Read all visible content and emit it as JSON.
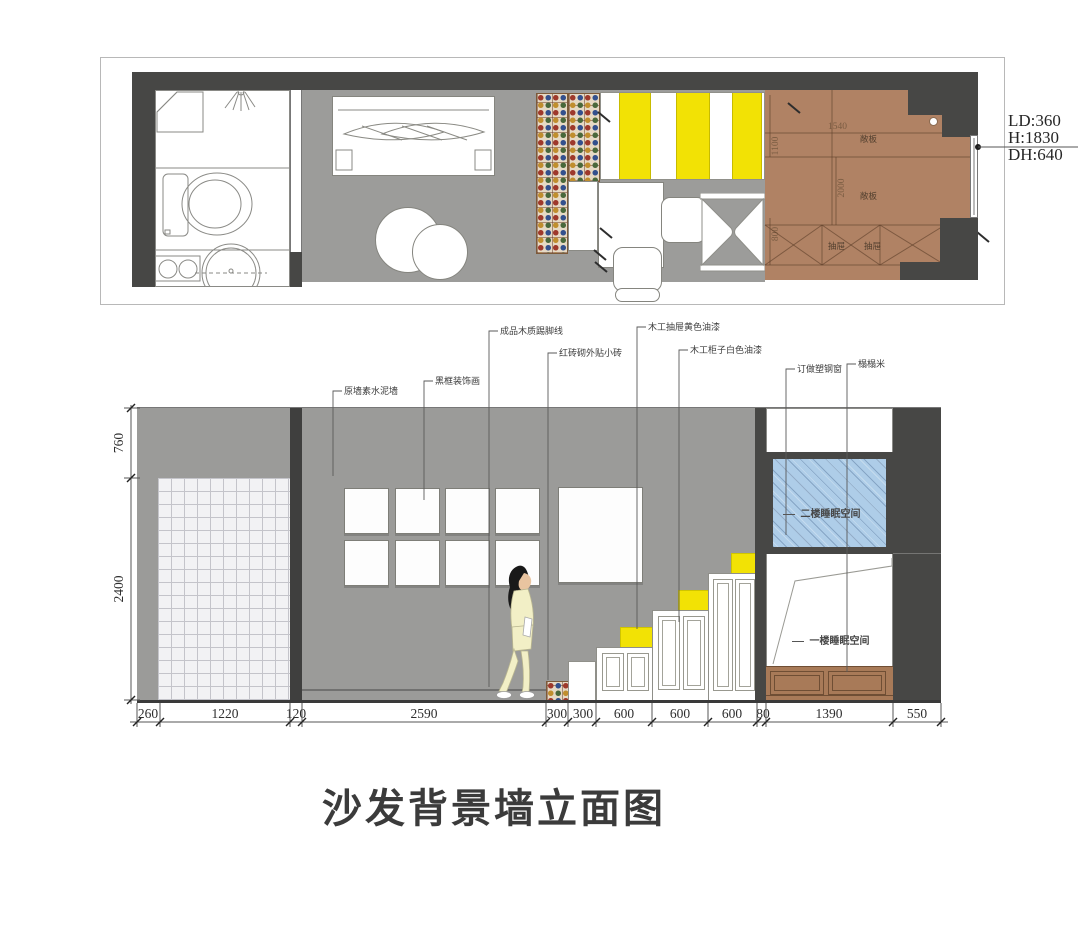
{
  "title": {
    "text": "沙发背景墙立面图"
  },
  "palette": {
    "wall_dark": "#474745",
    "floor_gray": "#9c9c9a",
    "wall_gray": "#9b9b99",
    "wood_brown": "#b08264",
    "tatami_brown": "#a87a58",
    "accent_yellow": "#f2e205",
    "glass_blue": "#aecde8",
    "tile_light": "#f2f2f4"
  },
  "plan": {
    "note": {
      "lines": [
        "LD:360",
        "H:1830",
        "DH:640"
      ]
    },
    "dims": {
      "width_top": "1540",
      "depth_left": "1100",
      "depth_mid": "2000",
      "depth_bottom": "800"
    },
    "labels": {
      "shelf_upper": "敞板",
      "shelf_lower": "敞板",
      "drawer_left": "抽屉",
      "drawer_right": "抽屉"
    }
  },
  "elevation": {
    "callouts": [
      "原墙素水泥墙",
      "黑框装饰画",
      "成品木质踢脚线",
      "红砖砌外贴小砖",
      "木工抽屉黄色油漆",
      "木工柜子白色油漆",
      "订做塑钢窗",
      "榻榻米"
    ],
    "spaces": {
      "upper": "二楼睡眠空间",
      "lower": "一楼睡眠空间"
    },
    "left_dims": [
      "760",
      "2400"
    ],
    "bottom_dims": [
      "260",
      "1220",
      "120",
      "2590",
      "300",
      "300",
      "600",
      "600",
      "600",
      "80",
      "1390",
      "550"
    ]
  }
}
